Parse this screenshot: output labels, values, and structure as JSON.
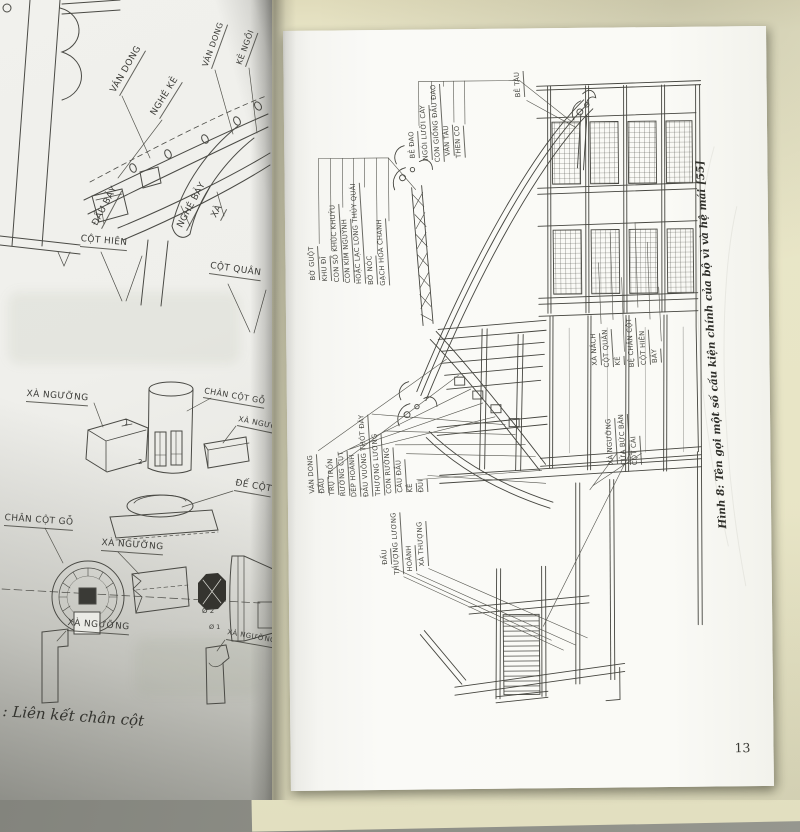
{
  "left_page": {
    "labels": {
      "nghe_ke": "NGHÉ KẺ",
      "van_dong_big": "VÁN DONG",
      "van_dong_small": "VÁN DONG",
      "ke_ngoi": "KẺ NGỒI",
      "dau_bay": "ĐẦU BẢY",
      "nghe_bay": "NGHÉ BẢY",
      "xa": "XÀ",
      "cot_hien": "CỘT HIÊN",
      "cot_quan": "CỘT QUÂN",
      "xa_nguong_1": "XÀ NGƯỠNG",
      "chan_cot_go_1": "CHÂN CỘT GỖ",
      "xa_nguong_right": "XÀ NGƯỠNG",
      "de_cot": "ĐẾ CỘT",
      "chan_cot_go_2": "CHÂN CỘT GỖ",
      "xa_nguong_2": "XÀ NGƯỠNG",
      "xa_nguong_3": "XÀ NGƯỠNG",
      "xa_nguong_right_2": "XÀ NGƯỠNG",
      "mark_1": "1",
      "mark_2": "2",
      "mark_d2": "Ø 2",
      "mark_d1": "Ø 1"
    },
    "caption": ": Liên kết chân cột"
  },
  "right_page": {
    "top_labels": [
      "BẺ ĐAO",
      "NGÓI LƯỠI CÀY",
      "CON GIỐNG ĐẦU ĐAO",
      "VÁN TÀU",
      "THEN CO"
    ],
    "be_tau": "BẺ TÀU",
    "ridge_labels": [
      "BỜ GUỘT",
      "KHU ĐĨ",
      "CON SỐ KHÚC KHUỶU",
      "CON KÌM NGUỶNH",
      "HOẶC LẠC LONG THỦY QUÁI",
      "BỜ NÓC",
      "GẠCH HOA CHANH"
    ],
    "mid_labels": [
      "VÁN DONG",
      "ĐẤU",
      "TRỤ TRỐN",
      "RƯỜNG CỤT",
      "DÉP HOÀNH",
      "ĐẤU VUÔNG THÓT ĐÁY",
      "THƯỢNG LƯƠNG",
      "CON RƯỜNG",
      "CÂU ĐẦU",
      "KẺ",
      "ĐUI"
    ],
    "lower_labels": [
      "ĐẤU",
      "THƯỢNG LƯƠNG",
      "HOÀNH",
      "XÀ THƯỢNG"
    ],
    "right_labels_a": [
      "XÀ NÁCH",
      "CỘT QUÂN",
      "KẺ",
      "BỆ CHÂN CỘT",
      "CỘT HIÊN",
      "BẢY"
    ],
    "right_labels_b": [
      "XÀ NGƯỠNG",
      "CỬA BỨC BÀN",
      "CỘT CÁI"
    ],
    "figure_caption": "Hình 8: Tên gọi một số cấu kiện chính của bộ vì và hệ mái [55]",
    "page_number": "13"
  }
}
